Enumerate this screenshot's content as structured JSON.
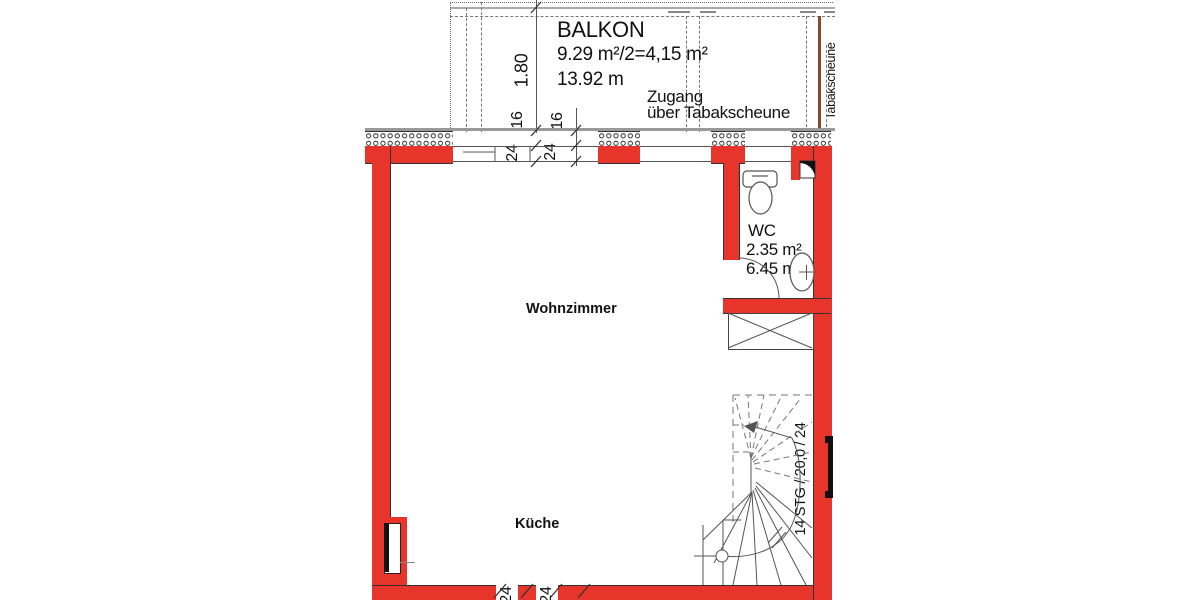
{
  "plan": {
    "balcony": {
      "title": "BALKON",
      "area": "9.29 m²/2=4,15 m²",
      "length": "13.92 m",
      "depth_dim": "1.80"
    },
    "access": {
      "line1": "Zugang",
      "line2": "über Tabakscheune"
    },
    "living_room_label": "Wohnzimmer",
    "kitchen_label": "Küche",
    "wc": {
      "title": "WC",
      "area": "2.35 m²",
      "perimeter": "6.45 m"
    },
    "stairs_label": "14 STG / 20,0 / 24",
    "side_vertical_label": "Tabakscheune",
    "dims": {
      "insulation_a": "16",
      "insulation_b": "16",
      "wall_a": "24",
      "wall_b": "24",
      "bottom_a": "24",
      "bottom_b": "24"
    }
  },
  "colors": {
    "wall_red": "#e8352b",
    "line_dark": "#333333",
    "line_mid": "#555555",
    "line_gray": "#999999",
    "wood_brown": "#8a4a2a"
  }
}
